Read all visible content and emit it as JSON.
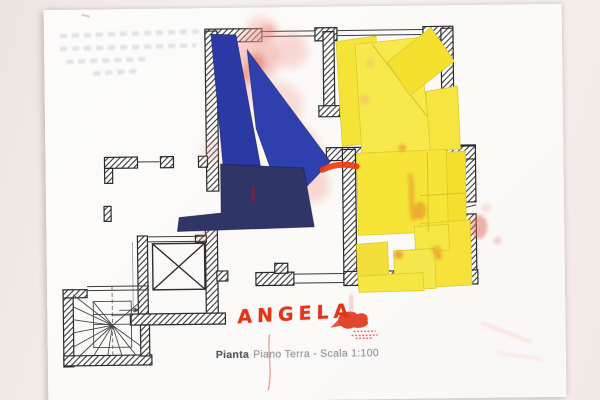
{
  "caption": {
    "word_bold": "Pianta",
    "rest": "Piano Terra - Scala 1:100",
    "full": "Pianta Piano Terra - Scala 1:100"
  },
  "handwriting": {
    "name": "ANGELA"
  },
  "plan": {
    "kind": "ground-floor architectural plan with paper collage",
    "scale": "1:100"
  },
  "colors": {
    "backdrop": "#f1ebe7",
    "paper": "#fcfbfa",
    "plan_line": "#2e2e2e",
    "collage_blue": "#2c3aa5",
    "collage_navy": "#2f3566",
    "collage_yellow": "#f6e336",
    "marker_red": "#e23418",
    "smudge_pink": "#ef9f96"
  }
}
